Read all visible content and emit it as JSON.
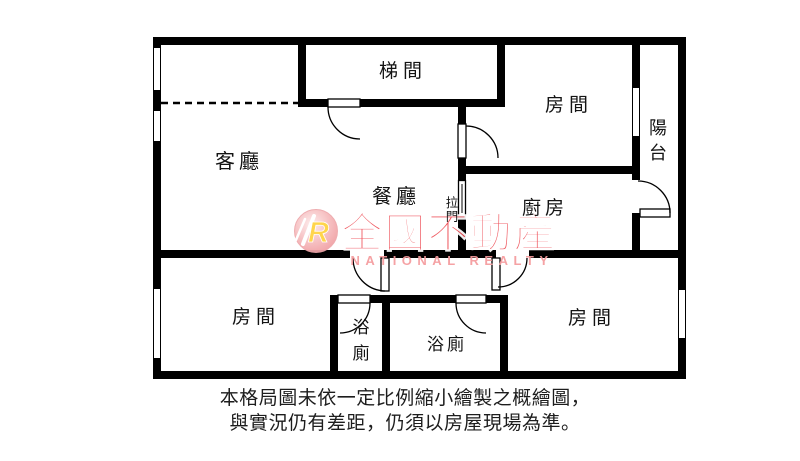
{
  "plan": {
    "type": "apartment-floor-plan",
    "wall_color": "#000000",
    "background_color": "#ffffff"
  },
  "rooms": {
    "living": "客廳",
    "dining": "餐廳",
    "stairwell": "梯間",
    "bedroom_ne": "房間",
    "kitchen": "廚房",
    "balcony": [
      "陽",
      "台"
    ],
    "bedroom_sw": "房間",
    "bedroom_se": "房間",
    "bath_small": [
      "浴",
      "廁"
    ],
    "bath_main": "浴廁",
    "sliding_door": [
      "拉",
      "門"
    ]
  },
  "watermark": {
    "logo_letter": "R",
    "brand": "全國不動產",
    "subtitle": "NATIONAL REALTY",
    "brand_color": "#ee4a52",
    "subtitle_color": "#f59b9e",
    "logo_accent_color": "#ffd23f",
    "logo_circle_color": "#f2a0a3"
  },
  "caption": {
    "line1": "本格局圖未依一定比例縮小繪製之概繪圖，",
    "line2": "與實況仍有差距，仍須以房屋現場為準。"
  }
}
